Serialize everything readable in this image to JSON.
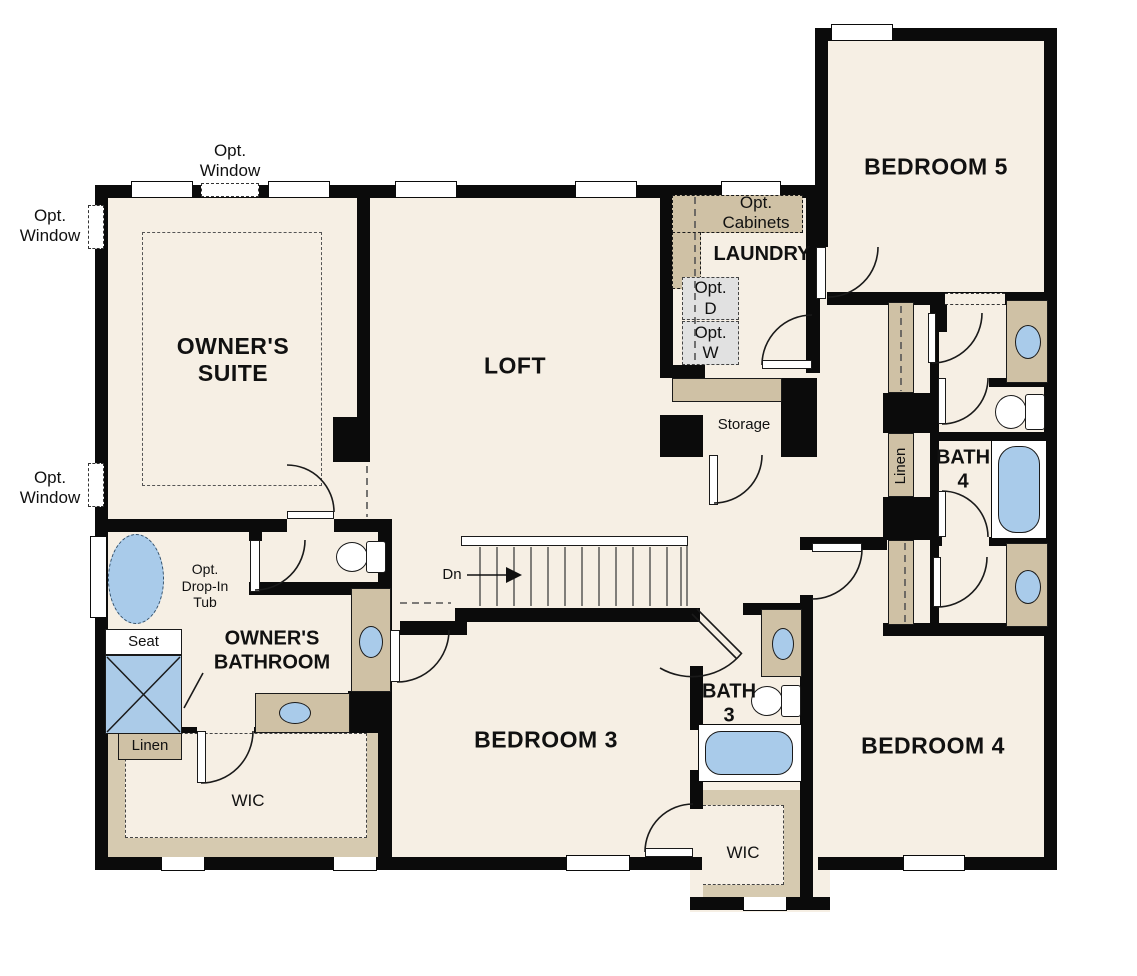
{
  "labels": {
    "opt_window": "Opt.\nWindow",
    "owners_suite": "OWNER'S\nSUITE",
    "loft": "LOFT",
    "opt_cabinets": "Opt.\nCabinets",
    "laundry": "LAUNDRY",
    "opt_dryer": "Opt.\nD",
    "opt_washer": "Opt.\nW",
    "bedroom5": "BEDROOM 5",
    "storage": "Storage",
    "linen": "Linen",
    "bath4": "BATH\n4",
    "down": "Dn",
    "opt_drop_in_tub": "Opt.\nDrop-In\nTub",
    "owners_bathroom": "OWNER'S\nBATHROOM",
    "seat": "Seat",
    "wic": "WIC",
    "bedroom3": "BEDROOM 3",
    "bath3": "BATH\n3",
    "bedroom4": "BEDROOM 4"
  },
  "colors": {
    "floor": "#f6efe4",
    "wall": "#0b0b0b",
    "cabinet_tan": "#cfc1a5",
    "closet_band_tan": "#d6cab0",
    "fixture_blue": "#a9cbea",
    "appliance_gray": "#e1e1e1",
    "line": "#1a1a1a"
  }
}
